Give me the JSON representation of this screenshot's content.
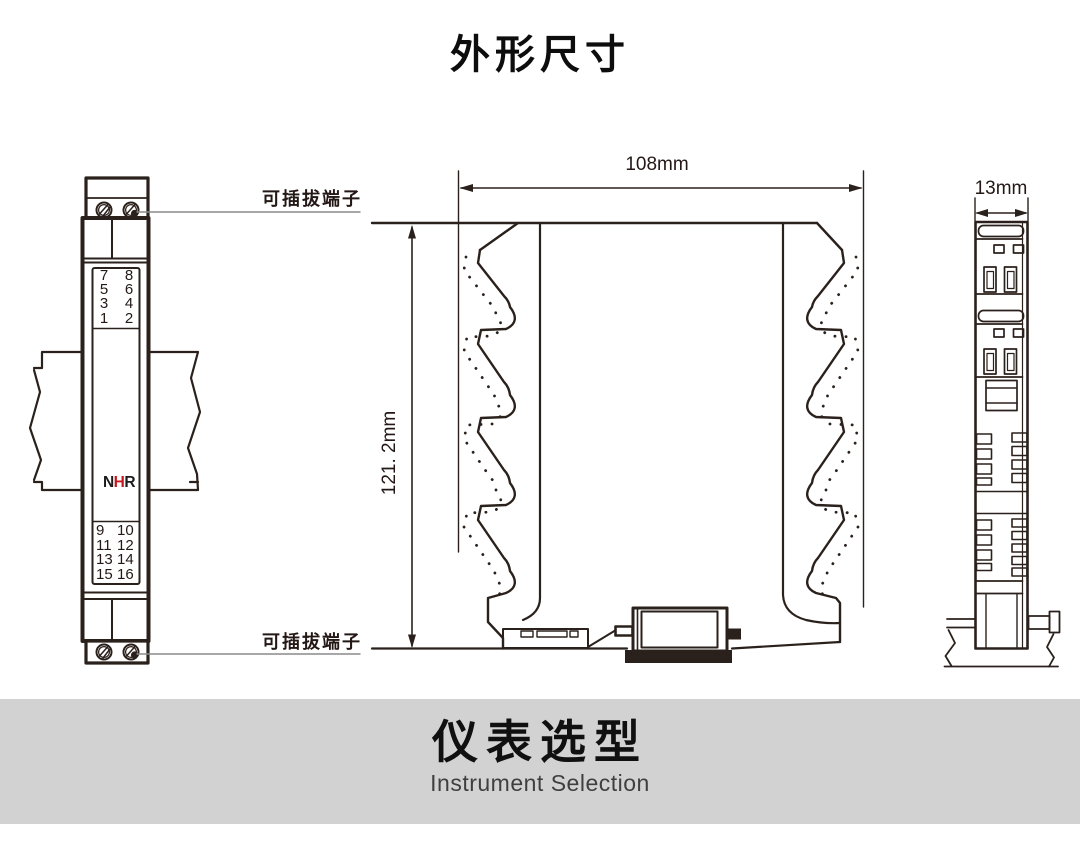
{
  "page": {
    "title": "外形尺寸"
  },
  "front_view": {
    "plug_label_top": "可插拔端子",
    "plug_label_bottom": "可插拔端子",
    "logo": {
      "n": "N",
      "h": "H",
      "r": "R"
    },
    "upper_terminals": {
      "left": [
        "7",
        "5",
        "3",
        "1"
      ],
      "right": [
        "8",
        "6",
        "4",
        "2"
      ]
    },
    "lower_terminals": {
      "left": [
        "9",
        "11",
        "13",
        "15"
      ],
      "right": [
        "10",
        "12",
        "14",
        "16"
      ]
    }
  },
  "side_view": {
    "width_label": "108mm",
    "height_label": "121. 2mm"
  },
  "edge_view": {
    "thickness_label": "13mm"
  },
  "footer": {
    "heading": "仪表选型",
    "subheading": "Instrument Selection"
  },
  "colors": {
    "line": "#2b211c",
    "logo_red": "#c8161d",
    "footer_bg": "#d2d2d2",
    "leader_line": "#8a8a8a",
    "text": "#231815"
  }
}
